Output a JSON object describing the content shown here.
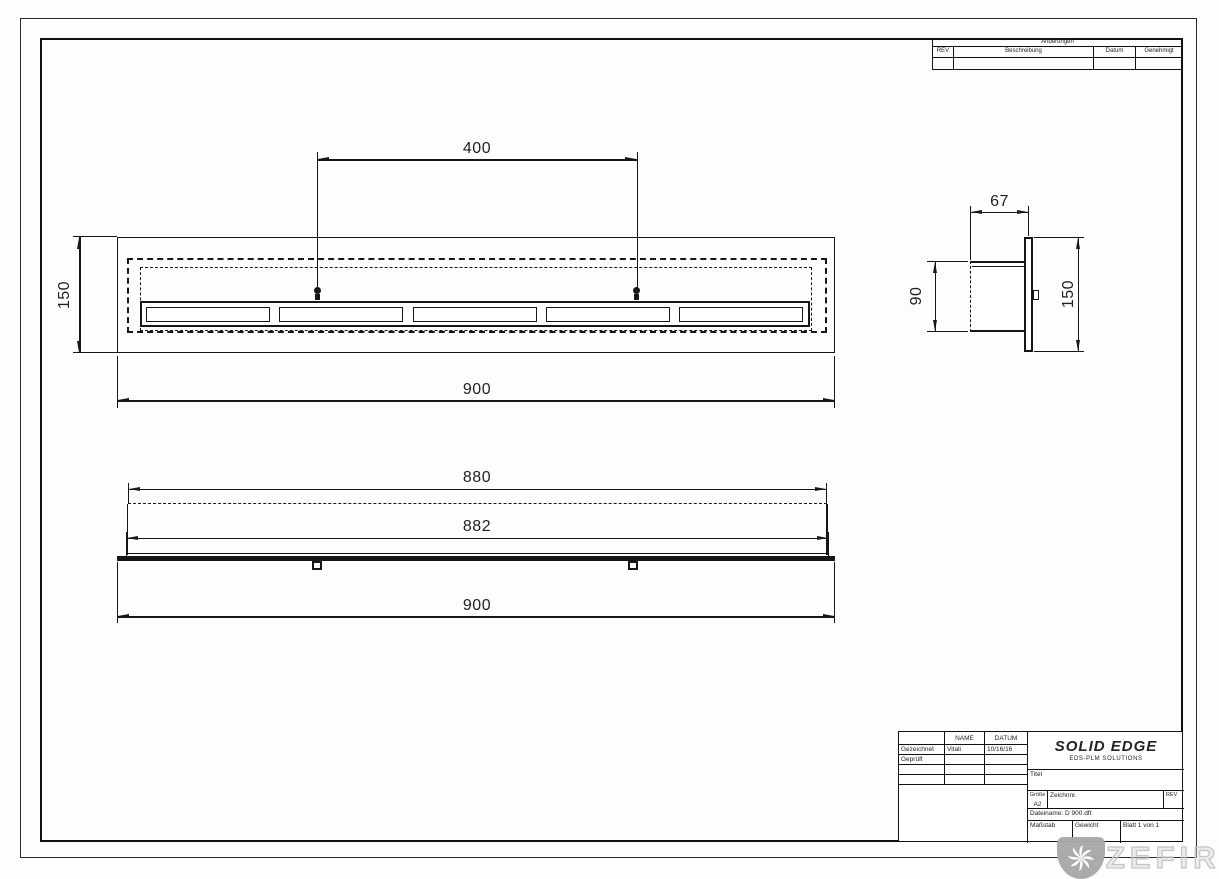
{
  "sheet": {
    "kind": "technical-drawing"
  },
  "revision_table": {
    "title": "Änderungen",
    "columns": [
      "REV",
      "Beschreibung",
      "Datum",
      "Genehmigt"
    ]
  },
  "title_block": {
    "headers": {
      "name": "NAME",
      "date": "DATUM"
    },
    "rows": {
      "drawn": {
        "label": "Gezeichnet",
        "name": "Vitali",
        "date": "10/16/16"
      },
      "checked": {
        "label": "Geprüft"
      }
    },
    "brand": {
      "name": "SOLID EDGE",
      "subtitle": "EDS-PLM SOLUTIONS"
    },
    "title_label": "Titel",
    "size": {
      "label": "Größe",
      "value": "A2"
    },
    "drawing_number_label": "Zeichnnr.",
    "rev_label": "REV",
    "filename": "Dateiname: D 900.dft",
    "scale_label": "Maßstab",
    "weight_label": "Gewicht",
    "sheet_label": "Blatt 1 von 1"
  },
  "dimensions": {
    "front_view": {
      "pin_spacing": "400",
      "height": "150",
      "overall_width": "900"
    },
    "side_view": {
      "depth": "67",
      "body_height": "90",
      "flange_height": "150"
    },
    "bottom_view": {
      "body_width": "880",
      "body_width_outer": "882",
      "overall_width": "900"
    }
  },
  "watermark": {
    "brand": "ZEFIRE"
  }
}
